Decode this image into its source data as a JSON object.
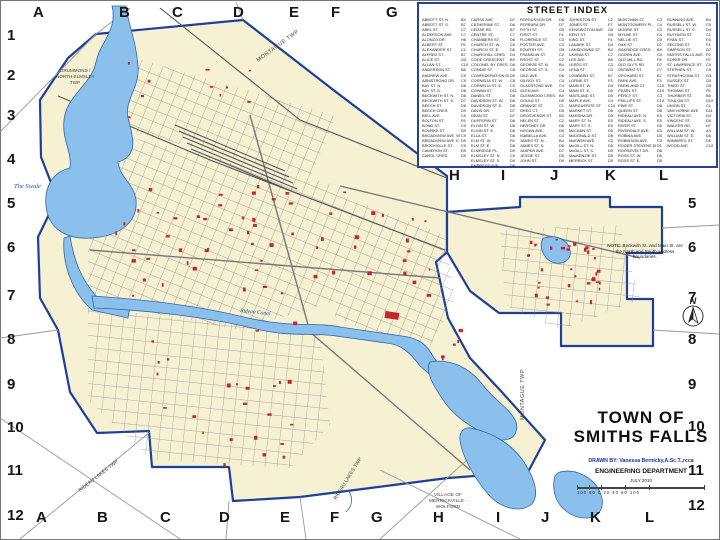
{
  "street_index": {
    "title": "STREET INDEX",
    "columns": [
      [
        [
          "ABBOTT ST. N.",
          "B4"
        ],
        [
          "ABBOTT ST. S.",
          "B7"
        ],
        [
          "ABEL ST.",
          "C7"
        ],
        [
          "ALDERSON AVE.",
          "C7"
        ],
        [
          "ALONZO DR.",
          "H6"
        ],
        [
          "ALBERT ST.",
          "F6"
        ],
        [
          "ALEXANDER ST.",
          "C1"
        ],
        [
          "ALFRED ST.",
          "B7"
        ],
        [
          "ALICE ST.",
          "G5"
        ],
        [
          "ALLAN ST.",
          "C10"
        ],
        [
          "ANDERSON ST.",
          "B6"
        ],
        [
          "ANDREW AVE.",
          "C9"
        ],
        [
          "ARMSTRONG DR.",
          "C9"
        ],
        [
          "BAY ST. N.",
          "D8"
        ],
        [
          "BAY ST. S.",
          "D8"
        ],
        [
          "BECKWITH ST. N.",
          "D6"
        ],
        [
          "BECKWITH ST. S.",
          "D7"
        ],
        [
          "BEECH ST.",
          "D8"
        ],
        [
          "BEECH CRES.",
          "D9"
        ],
        [
          "BELL AVE.",
          "C9"
        ],
        [
          "BOLTON ST.",
          "F8"
        ],
        [
          "BOND ST.",
          "C9"
        ],
        [
          "BOURKE ST.",
          "D9"
        ],
        [
          "BROADVIEW AVE. W.",
          "C9"
        ],
        [
          "BROADVIEW AVE. E.",
          "D9"
        ],
        [
          "BROCKVILLE ST.",
          "C9"
        ],
        [
          "CAMERON ST.",
          "D9"
        ],
        [
          "CAROL CRES.",
          "D9"
        ]
      ],
      [
        [
          "CARSS AVE.",
          "D7"
        ],
        [
          "CATHERINE ST.",
          "D6"
        ],
        [
          "CEDAR RD.",
          "B7"
        ],
        [
          "CENTRE ST.",
          "C7"
        ],
        [
          "CHAMBERS ST.",
          "D6"
        ],
        [
          "CHURCH ST. W.",
          "C6"
        ],
        [
          "CHURCH ST. E.",
          "D6"
        ],
        [
          "CHURCHILL CRES.",
          "D4"
        ],
        [
          "CODE CRESCENT",
          "B9"
        ],
        [
          "COLONEL BY CRES.",
          "D8"
        ],
        [
          "CONDIE ST.",
          "C8"
        ],
        [
          "CONFEDERATION DR.",
          "D9"
        ],
        [
          "CORNELIA ST. W.",
          "C8"
        ],
        [
          "CORNELIA ST. E.",
          "C9"
        ],
        [
          "COWAN ST.",
          "D11"
        ],
        [
          "DANIEL ST.",
          "D8"
        ],
        [
          "DAVIDSON ST. W.",
          "D8"
        ],
        [
          "DAVIDSON ST. E.",
          "D8"
        ],
        [
          "DAVIS DR.",
          "D7"
        ],
        [
          "DEAN ST.",
          "D7"
        ],
        [
          "DUFFERIN ST.",
          "D8"
        ],
        [
          "ELGIN ST. W.",
          "D8"
        ],
        [
          "ELGIN ST. E.",
          "D8"
        ],
        [
          "ELLA ST.",
          "D8"
        ],
        [
          "ELM ST. W.",
          "F8"
        ],
        [
          "ELM ST. E.",
          "D8"
        ],
        [
          "ELMRIDGE PL.",
          "D9"
        ],
        [
          "ELMSLEY ST. N.",
          "C9"
        ],
        [
          "ELMSLEY ST. S.",
          "D9"
        ],
        [
          "EMPRESS AVE.",
          "D9"
        ]
      ],
      [
        [
          "FERGUSSON DR.",
          "D8"
        ],
        [
          "FERRARA DR.",
          "D7"
        ],
        [
          "FIFTH ST.",
          "G5"
        ],
        [
          "FIRST ST.",
          "F4"
        ],
        [
          "FLORENCE ST.",
          "C3"
        ],
        [
          "FOSTER AVE.",
          "C3"
        ],
        [
          "FOURTH ST.",
          "G5"
        ],
        [
          "FRANKLIN ST.",
          "C2"
        ],
        [
          "FROST ST.",
          "C2"
        ],
        [
          "GEORGE ST. N.",
          "B4"
        ],
        [
          "GEORGE ST. S.",
          "C4"
        ],
        [
          "GILE AVE.",
          "D6"
        ],
        [
          "GILROY ST.",
          "C4"
        ],
        [
          "GLADSTONE AVE.",
          "C4"
        ],
        [
          "GLEN AVE.",
          "C4"
        ],
        [
          "GLENWOOD CRES.",
          "B9"
        ],
        [
          "GOULD ST.",
          "D5"
        ],
        [
          "GRANGE ST.",
          "C1"
        ],
        [
          "GREG CT.",
          "D5"
        ],
        [
          "GROSVENOR ST.",
          "B3"
        ],
        [
          "HELEN ST.",
          "C2"
        ],
        [
          "HERSHEY DR.",
          "D6"
        ],
        [
          "HOGAN AVE.",
          "D5"
        ],
        [
          "ISABELLA AVE.",
          "C4"
        ],
        [
          "JAMES ST. N.",
          "B4"
        ],
        [
          "JAMES ST. S.",
          "D6"
        ],
        [
          "JASPER AVE.",
          "D7"
        ],
        [
          "JESSIE ST.",
          "D5"
        ],
        [
          "JOHN ST.",
          "D9"
        ]
      ],
      [
        [
          "JOHNSTON ST.",
          "C2"
        ],
        [
          "JONES ST.",
          "F7"
        ],
        [
          "KENSINGTON AVE.",
          "G5"
        ],
        [
          "KENT ST.",
          "G5"
        ],
        [
          "KING ST.",
          "F4"
        ],
        [
          "LANARK ST.",
          "D4"
        ],
        [
          "LANSDOWNE ST.",
          "B4"
        ],
        [
          "LAVINIA ST.",
          "C7"
        ],
        [
          "LEE AVE.",
          "B6"
        ],
        [
          "LEEDS ST.",
          "C3"
        ],
        [
          "LENA ST.",
          "C3"
        ],
        [
          "LOMBARD ST.",
          "B7"
        ],
        [
          "LORNE ST.",
          "F3"
        ],
        [
          "MAIN ST. W.",
          "D4"
        ],
        [
          "MAIN ST. E.",
          "D5"
        ],
        [
          "MAITLAND ST.",
          "D5"
        ],
        [
          "MAPLE AVE.",
          "C4"
        ],
        [
          "MARGUERITE ST.",
          "C10"
        ],
        [
          "MARKET ST.",
          "D5"
        ],
        [
          "MARSHA DR.",
          "D5"
        ],
        [
          "MARY ST. N.",
          "E5"
        ],
        [
          "MARY ST. S.",
          "E5"
        ],
        [
          "McCANN ST.",
          "D5"
        ],
        [
          "McDONALD ST.",
          "D6"
        ],
        [
          "McEWEN AVE.",
          "C3"
        ],
        [
          "McGILL ST. N.",
          "D5"
        ],
        [
          "McGILL ST. S.",
          "D5"
        ],
        [
          "MacKENZIE ST.",
          "D5"
        ],
        [
          "MERRICK ST.",
          "D5"
        ]
      ],
      [
        [
          "MONTMAN ST.",
          "C3"
        ],
        [
          "MONTGOMERY PL.",
          "C4"
        ],
        [
          "MOORE ST.",
          "C3"
        ],
        [
          "MYLNE ST.",
          "C4"
        ],
        [
          "NELLIE ST.",
          "C9"
        ],
        [
          "OAK ST.",
          "D7"
        ],
        [
          "OAKRIDGE CRES.",
          "B9"
        ],
        [
          "OGDEN AVE.",
          "C4"
        ],
        [
          "OLD MILL RD.",
          "F8"
        ],
        [
          "OLD SLY'S RD",
          "D7"
        ],
        [
          "ONTARIO ST.",
          "C7"
        ],
        [
          "ORCHARD ST.",
          "B7"
        ],
        [
          "PARK AVE.",
          "F3"
        ],
        [
          "PARKLAND CT.",
          "C10"
        ],
        [
          "PEARL ST.",
          "C10"
        ],
        [
          "PERCY ST.",
          "C3"
        ],
        [
          "PHILLIPS ST.",
          "C10"
        ],
        [
          "PINE ST.",
          "D8"
        ],
        [
          "QUEEN ST.",
          "D8"
        ],
        [
          "RIDEAU AVE. N.",
          "E5"
        ],
        [
          "RIDEAU AVE. S.",
          "E5"
        ],
        [
          "RIVER ST.",
          "D5"
        ],
        [
          "RIVERDALE AVE.",
          "E5"
        ],
        [
          "ROBINA AVE.",
          "D5"
        ],
        [
          "ROBINSON AVE.",
          "C3"
        ],
        [
          "ROGER STEVENS DR.",
          "D1"
        ],
        [
          "ROOSEVELT DR.",
          "D6"
        ],
        [
          "ROSS ST. W.",
          "D5"
        ],
        [
          "ROSS ST. E.",
          "D5"
        ]
      ],
      [
        [
          "RUNNING AVE.",
          "B4"
        ],
        [
          "RUSSELL ST. W.",
          "C9"
        ],
        [
          "RUSSELL ST. E.",
          "D4"
        ],
        [
          "RUTHVEN ST.",
          "C1"
        ],
        [
          "RYAN ST.",
          "E5"
        ],
        [
          "SECOND ST.",
          "F4"
        ],
        [
          "SIMPSON ST.",
          "D7"
        ],
        [
          "SMITHS FALLS AVE.",
          "F5"
        ],
        [
          "SOPER DR.",
          "H7"
        ],
        [
          "ST. LAWRENCE ST.",
          "C9"
        ],
        [
          "STEPHEN ST.",
          "C9"
        ],
        [
          "STRATHCONA ST.",
          "G3"
        ],
        [
          "SUSSEX ST.",
          "G5"
        ],
        [
          "THIRD ST.",
          "G5"
        ],
        [
          "THOMAS ST.",
          "F5"
        ],
        [
          "THURBER ST.",
          "B5"
        ],
        [
          "TOULON ST.",
          "D10"
        ],
        [
          "UNION ST.",
          "C1"
        ],
        [
          "VAN HORNE AVE.",
          "D11"
        ],
        [
          "VICTORIA ST.",
          "D4"
        ],
        [
          "VINCENT ST.",
          "D5"
        ],
        [
          "WALKER RD.",
          "H7"
        ],
        [
          "WILLIAM ST. W.",
          "A4"
        ],
        [
          "WILLIAM ST. E.",
          "D6"
        ],
        [
          "WINNIPEG ST.",
          "D5"
        ],
        [
          "WOOD AVE.",
          "C10"
        ]
      ]
    ]
  },
  "note": {
    "text": "NOTE: Beckwith St. and Main St. are the North and South address boundaries."
  },
  "title_block": {
    "line1": "TOWN OF",
    "line2": "SMITHS FALLS",
    "drawn_by": "DRAWN BY: Vanessa Bernicky,A.Sc.T.,rcca",
    "dept": "ENGINEERING DEPARTMENT",
    "date": "JULY 2010",
    "scale_labels": "100 50 0 20  40  60  100"
  },
  "grid": {
    "top": [
      "A",
      "B",
      "C",
      "D",
      "E",
      "F",
      "G"
    ],
    "mid": [
      "H",
      "I",
      "J",
      "K",
      "L"
    ],
    "bottom": [
      "A",
      "B",
      "C",
      "D",
      "E",
      "F",
      "G",
      "H",
      "I",
      "J",
      "K",
      "L"
    ],
    "left": [
      "1",
      "2",
      "3",
      "4",
      "5",
      "6",
      "7",
      "8",
      "9",
      "10",
      "11",
      "12"
    ],
    "right": [
      "5",
      "6",
      "7",
      "8",
      "9",
      "10",
      "11",
      "12"
    ]
  },
  "map": {
    "labels": {
      "montague_top": "MONTAGUE TWP",
      "montague_east": "MONTAGUE TWP",
      "drummond1": "DRUMMOND /",
      "drummond2": "NORTH ELMSLEY",
      "drummond3": "TWP",
      "swale": "The Swale",
      "canal": "Rideau Canal",
      "rideau_lakes_1": "RIDEAU LAKES TWP",
      "rideau_lakes_2": "RIDEAU LAKES TWP",
      "village1": "VILLAGE OF",
      "village2": "MERRICKVILLE -",
      "village3": "WOLFORD",
      "north": "N"
    },
    "colors": {
      "town_fill": "#f6f1d3",
      "boundary": "#1c3f99",
      "water_fill": "#8cc0ec",
      "water_line": "#2e66a8",
      "street": "#8f8f8f",
      "building": "#c1272d"
    }
  }
}
